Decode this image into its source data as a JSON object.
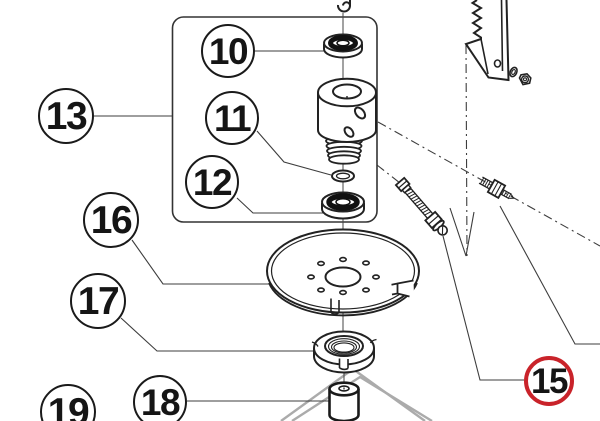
{
  "diagram": {
    "background": "#ffffff",
    "line_color": "#2e2e2e",
    "leader_color": "#3d3d3d",
    "assembly_line_color": "#ababab",
    "highlight_color": "#c9232a",
    "callouts": [
      {
        "label": "10",
        "x": 228,
        "y": 51,
        "r": 27,
        "ring": "#1a1a1a",
        "ring_width": 2.6
      },
      {
        "label": "11",
        "x": 232,
        "y": 118,
        "r": 27,
        "ring": "#1a1a1a",
        "ring_width": 2.6
      },
      {
        "label": "12",
        "x": 212,
        "y": 182,
        "r": 27,
        "ring": "#1a1a1a",
        "ring_width": 2.6
      },
      {
        "label": "13",
        "x": 66,
        "y": 116,
        "r": 28,
        "ring": "#1a1a1a",
        "ring_width": 2.6
      },
      {
        "label": "15",
        "x": 549,
        "y": 381,
        "r": 25,
        "ring": "#c9232a",
        "ring_width": 4.5
      },
      {
        "label": "16",
        "x": 111,
        "y": 220,
        "r": 28,
        "ring": "#1a1a1a",
        "ring_width": 2.6
      },
      {
        "label": "17",
        "x": 98,
        "y": 301,
        "r": 28,
        "ring": "#1a1a1a",
        "ring_width": 2.6
      },
      {
        "label": "18",
        "x": 160,
        "y": 402,
        "r": 27,
        "ring": "#1a1a1a",
        "ring_width": 2.6
      },
      {
        "label": "19",
        "x": 68,
        "y": 412,
        "r": 28,
        "ring": "#1a1a1a",
        "ring_width": 2.6
      }
    ],
    "parts": [
      {
        "icon": "bearing-icon",
        "callout": "10"
      },
      {
        "icon": "o-ring-icon",
        "callout": "11"
      },
      {
        "icon": "bearing-icon",
        "callout": "12"
      },
      {
        "icon": "spindle-assembly-box-icon",
        "callout": "13"
      },
      {
        "icon": "blade-mounting-bolts-icon",
        "callout": "15"
      },
      {
        "icon": "cover-plate-icon",
        "callout": "16"
      },
      {
        "icon": "lock-nut-icon",
        "callout": "17"
      },
      {
        "icon": "spacer-cylinder-icon",
        "callout": "18"
      },
      {
        "icon": "partial-circle-icon",
        "callout": "19"
      }
    ]
  }
}
